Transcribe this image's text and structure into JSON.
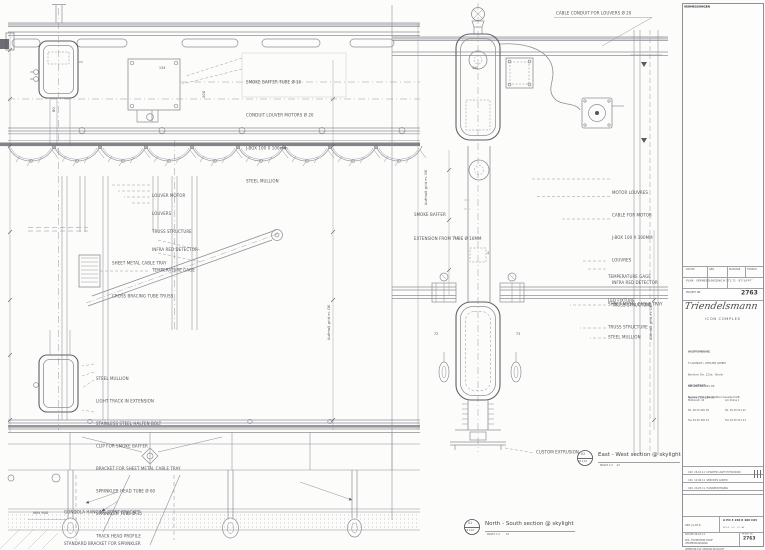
{
  "sheet": {
    "bg_color": "#fcfcfb",
    "line_color": "#8e8f97",
    "dark_color": "#53545b",
    "project_number": "2763"
  },
  "left_drawing": {
    "title_number": "01",
    "title_scale": "A4 1:10",
    "title": "North - South section @ skylight",
    "title_sub": "MASST. 1:2        A3",
    "labels": {
      "top_block": [
        "SMOKE BAFFER TUBE Ø 16",
        "CONDUIT LOUVER MOTORS Ø 20",
        "J-BOX 100 X 100mm",
        "STEEL MULLION"
      ],
      "louver_block": [
        "LOUVER MOTOR",
        "LOUVERS",
        "TRUSS STRUCTURE",
        "INFRA RED DETECTOR"
      ],
      "tray_block": [
        "SHEET METAL CABLE TRAY",
        "CROSS BRACING TUBE TRUSS"
      ],
      "temp_gage": "TEMPERATURE GAGE",
      "mullion_block": [
        "STEEL MULLION",
        "LIGHT TRACK IN EXTENSION",
        "STAINLESS STEEL HALFEN BOLT",
        "CLIP FOR SMOKE BAFFER",
        "BRACKET FOR SHEET METAL CABLE TRAY",
        "SPRINKLER HEAD TUBE Ø 60",
        "SPRINKLER TUBE Ø 35",
        "TRACK HEAD PROFILE"
      ],
      "bottom_block": [
        "GONDOLA HANGING POINT BRACKET",
        "STANDARD BRACKET FOR SPRINKLER"
      ],
      "min_dim": "MIN 900",
      "num_134": "134",
      "num_80": "80",
      "num_200": "200"
    },
    "vertical_dim_label": "Aufmaß grid m. OK"
  },
  "right_drawing": {
    "title_number": "02",
    "title_scale": "A6 1:10",
    "title": "East - West section @ skylight",
    "title_sub": "MASST. 1:2     A3",
    "labels": {
      "cable_conduit": "CABLE CONDUIT FOR LOUVERS Ø 20",
      "motor_block": [
        "MOTOR LOUVRES",
        "CABLE FOR MOTOR",
        "J-BOX 100 X 100MM",
        "LOUVRES",
        "INFRA RED DETECTOR",
        "TRUSS STRUCTURE"
      ],
      "smoke_block": [
        "SMOKE BAFFER",
        "EXTENSION FROM TUBE Ø 16MM"
      ],
      "temp_gage": "TEMPERATURE GAGE",
      "led_fixture": "LED FIXTURE",
      "cable_tray": "SHEET METAL CABLE TRAY",
      "truss": "TRUSS STRUCTURE",
      "mullion": "STEEL MULLION",
      "custom_extrusion": "CUSTOM EXTRUSION",
      "num_100": "100",
      "num_54": "54",
      "num_4": "4",
      "num_72": "72",
      "num_73": "73"
    },
    "vertical_dim_label": "Aufmaß grid m. OK"
  },
  "title_block": {
    "top_label": "VERMESSUNGEN",
    "field_labels": {
      "date": "DATUM",
      "drawn": "GEZ.",
      "scale": "MASSTAB",
      "format": "FORMAT"
    },
    "survey_line": "PLAN · VERMESSUNGSING",
    "coords": "H 171.71 · 87°16'47\"",
    "project_no_label": "PROJEKT NR.",
    "project_no": "2763",
    "logo_script": "Triendelsmann",
    "logo_sub": "ICON COMPLEX",
    "address_1": [
      "AUSFÜHRUNG",
      "T-LOUNGE / ATELIER GMBH",
      "Berliner Str. 123a · Berlin",
      "Tel. 49 (30) 284 09",
      "Fax 49 (30) 284 09"
    ],
    "address_2_header": "ARCHITEKT",
    "address_2_line": "Nelson Fittke Bauhütten Gesellschaft",
    "address_2_col1": [
      "Mühlenstr. 44",
      "Tel. 49 30 420 18",
      "Fax 49 30 420 19"
    ],
    "address_2_col2": [
      "Am Zirkus 1",
      "Tel. 49 30 511 22",
      "Fax 49 30 511 23"
    ],
    "revisions": [
      {
        "code": "C02",
        "date": "26.10.11",
        "desc": "UPDATED LIGHT EXTRUSION"
      },
      {
        "code": "C01",
        "date": "14.06.11",
        "desc": "SERVICES ADDED"
      },
      {
        "code": "C00",
        "date": "26.05.11",
        "desc": "HANDZEICHNUNG"
      }
    ],
    "bottom_left": [
      "GEZ. JS-AH-R",
      "DATUM 26.10.11",
      "VERMESSUNGSING"
    ],
    "drawing_no": "A PO 3 240 8 106 C03",
    "scales_row": "SK 1:5 · 1:2 · 1:1 · A3",
    "sheet_title": [
      "ROL. EXHIBITION ROOF",
      "INTERIOR ELV. DESIGN SKYLIGHT",
      "AND IN CAVITY"
    ]
  }
}
